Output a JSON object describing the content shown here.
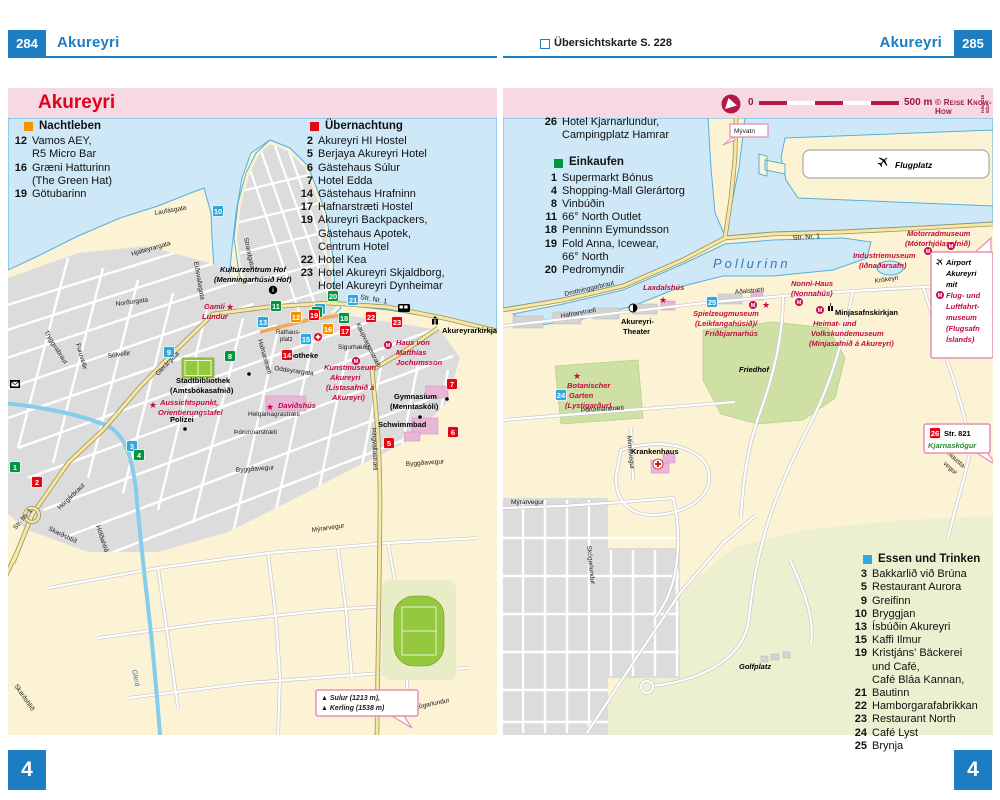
{
  "colors": {
    "header_blue": "#1d7dc2",
    "title_pink_bg": "#f7d9e4",
    "title_red": "#e2001a",
    "crimson": "#9b1440",
    "badge_orange": "#f39200",
    "badge_red": "#e30613",
    "badge_green": "#009640",
    "badge_blue": "#2fa8e0",
    "map_red": "#c30b3f",
    "sea": "#cfe8f7",
    "land": "#fbf3d4",
    "park_green": "#cfe0a4",
    "road_yellow": "#f6e7a2"
  },
  "left": {
    "header": {
      "page": "284",
      "title": "Akureyri"
    },
    "title": "Akureyri",
    "corner": "4",
    "nightlife": {
      "title": "Nachtleben",
      "items": [
        {
          "num": "12",
          "lines": [
            "Vamos AEY,",
            "R5 Micro Bar"
          ]
        },
        {
          "num": "16",
          "lines": [
            "Græni Hatturinn",
            "(The Green Hat)"
          ]
        },
        {
          "num": "19",
          "lines": [
            "Götubarinn"
          ]
        }
      ]
    },
    "lodging": {
      "title": "Übernachtung",
      "items": [
        {
          "num": "2",
          "lines": [
            "Akureyri HI Hostel"
          ]
        },
        {
          "num": "5",
          "lines": [
            "Berjaya Akureyri Hotel"
          ]
        },
        {
          "num": "6",
          "lines": [
            "Gästehaus Súlur"
          ]
        },
        {
          "num": "7",
          "lines": [
            "Hotel Edda"
          ]
        },
        {
          "num": "14",
          "lines": [
            "Gästehaus Hrafninn"
          ]
        },
        {
          "num": "17",
          "lines": [
            "Hafnarstræti Hostel"
          ]
        },
        {
          "num": "19",
          "lines": [
            "Akureyri Backpackers,",
            "Gästehaus Apotek,",
            "Centrum Hotel"
          ]
        },
        {
          "num": "22",
          "lines": [
            "Hotel Kea"
          ]
        },
        {
          "num": "23",
          "lines": [
            "Hotel Akureyri Skjaldborg,",
            "Hotel Akureyri Dynheimar"
          ]
        }
      ]
    },
    "map": {
      "streets": {
        "laufasgata": "Laufásgata",
        "hjalteyrargata": "Hjalteyrargata",
        "strandgata": "Strandgata",
        "eidsvallagata": "Eiðsvallagata",
        "nordurgata": "Norðurgata",
        "glerargata": "Glerárgata",
        "solvellir": "Sólvellir",
        "furuvellir": "Furuvellir",
        "tryggvabraut": "Tryggvabraut",
        "horgarbraut": "Hörgárbraut",
        "strnr1": "Str. Nr. 1",
        "skardshlid": "Skarðshlíð",
        "hofdahlid": "Höfðahlíð",
        "oddeyrargata": "Oddeyrargata",
        "helgamagrastraeti": "Helgamagrastræti",
        "thorunnarstraeti": "Þórunnarstræti",
        "byggdavegur": "Byggðavegur",
        "myrarvegur": "Mýrarvegur",
        "thingvallastraeti": "Þingvallastræti",
        "skogarlundur": "Skógarlundur",
        "hafnarstraeti": "Hafnarstræti",
        "kaupvangsstraeti": "Kaupvangsstræti",
        "rathaus1": "Rathaus-",
        "rathaus2": "platz",
        "glera": "Glerá"
      },
      "pois": {
        "hof1": "Kulturzentrum Hof",
        "hof2": "(Menningarhúsið Hof)",
        "gamli1": "Gamli",
        "gamli2": "Lundur",
        "kirkja": "Akureyrarkirkja",
        "haus1": "Haus von",
        "haus2": "Matthías",
        "haus3": "Jochumsson",
        "apotheke": "Apotheke",
        "sigurhaedir": "Sigurhæðir",
        "kunst1": "Kunstmuseum",
        "kunst2": "Akureyri",
        "kunst3": "(Listasafnið á",
        "kunst4": "Akureyri)",
        "gym1": "Gymnasium",
        "gym2": "(Menntaskóli)",
        "schwimmbad": "Schwimmbad",
        "bib1": "Stadtbibliothek",
        "bib2": "(Amtsbókasafnið)",
        "aus1": "Aussichtspunkt,",
        "aus2": "Orientierungstafel",
        "davidshus": "Davíðshús",
        "polizei": "Polizei"
      },
      "sign": {
        "line1": "▲ Sulur (1213 m),",
        "line2": "▲ Kerling (1538 m)"
      },
      "badges": {
        "1": "1",
        "2": "2",
        "3": "3",
        "4": "4",
        "5": "5",
        "6": "6",
        "7": "7",
        "8": "8",
        "9": "9",
        "10": "10",
        "11": "11",
        "12": "12",
        "13": "13",
        "14": "14",
        "15": "15",
        "16": "16",
        "17": "17",
        "18": "18",
        "19": "19",
        "20": "20",
        "21": "21",
        "22": "22",
        "23": "23"
      }
    }
  },
  "right": {
    "header": {
      "ref": "Übersichtskarte S. 228",
      "title": "Akureyri",
      "page": "285"
    },
    "scalebar": {
      "zero": "0",
      "label": "500 m",
      "copyright": "© Reise Know-How",
      "edition1": "Island18",
      "edition2": "6/24"
    },
    "corner": "4",
    "lodging_cont": {
      "num": "26",
      "lines": [
        "Hotel Kjarnarlundur,",
        "Campingplatz Hamrar"
      ]
    },
    "shopping": {
      "title": "Einkaufen",
      "items": [
        {
          "num": "1",
          "lines": [
            "Supermarkt Bónus"
          ]
        },
        {
          "num": "4",
          "lines": [
            "Shopping-Mall Glerártorg"
          ]
        },
        {
          "num": "8",
          "lines": [
            "Vinbúðin"
          ]
        },
        {
          "num": "11",
          "lines": [
            "66° North Outlet"
          ]
        },
        {
          "num": "18",
          "lines": [
            "Penninn Eymundsson"
          ]
        },
        {
          "num": "19",
          "lines": [
            "Fold Anna, Icewear,",
            "66° North"
          ]
        },
        {
          "num": "20",
          "lines": [
            "Pedromyndir"
          ]
        }
      ]
    },
    "dining": {
      "title": "Essen und Trinken",
      "items": [
        {
          "num": "3",
          "lines": [
            "Bakkarlið við Brúna"
          ]
        },
        {
          "num": "5",
          "lines": [
            "Restaurant Aurora"
          ]
        },
        {
          "num": "9",
          "lines": [
            "Greifinn"
          ]
        },
        {
          "num": "10",
          "lines": [
            "Bryggjan"
          ]
        },
        {
          "num": "13",
          "lines": [
            "Ísbúðin Akureyri"
          ]
        },
        {
          "num": "15",
          "lines": [
            "Kaffi Ilmur"
          ]
        },
        {
          "num": "19",
          "lines": [
            "Kristjáns' Bäckerei",
            "und Café,",
            "Café Bláa Kannan,"
          ]
        },
        {
          "num": "21",
          "lines": [
            "Bautinn"
          ]
        },
        {
          "num": "22",
          "lines": [
            "Hamborgarafabrikkan"
          ]
        },
        {
          "num": "23",
          "lines": [
            "Restaurant North"
          ]
        },
        {
          "num": "24",
          "lines": [
            "Café Lyst"
          ]
        },
        {
          "num": "25",
          "lines": [
            "Brynja"
          ]
        }
      ]
    },
    "map": {
      "water": "Pollurinn",
      "streets": {
        "drottninggarbraut": "Drottninggarbraut",
        "hafnarstraeti": "Hafnarstræti",
        "adalstraeti": "Aðalstræti",
        "strnr1": "Str. Nr. 1",
        "krokeyri": "Krókeyri",
        "nausta1": "Nausta-",
        "nausta2": "vegur",
        "myrarvegur": "Mýrarvegur",
        "mimisvegur": "Mímisvegur",
        "thorunnarstraeti": "Þórunnarstræti",
        "skogarlundur": "Skógarlundur"
      },
      "pois": {
        "flugplatz": "Flugplatz",
        "motorrad1": "Motorradmuseum",
        "motorrad2": "(Mótorhjólasafnið)",
        "industrie1": "Industriemuseum",
        "industrie2": "(Iðnaðarsafn)",
        "nonni1": "Nonni-Haus",
        "nonni2": "(Nonnahús)",
        "laxdalshus": "Laxdalshús",
        "spiel1": "Spielzeugmuseum",
        "spiel2": "(Leikfangahúsið)/",
        "spiel3": "Friðbjarnarhús",
        "minjakirkja": "Minjasafnskirkjan",
        "heimat1": "Heimat- und",
        "heimat2": "Volkskundemuseum",
        "heimat3": "(Minjasafnið á Akureyri)",
        "friedhof": "Friedhof",
        "theater1": "Akureyri-",
        "theater2": "Theater",
        "botan1": "Botanischer",
        "botan2": "Garten",
        "botan3": "(Lystigarður)",
        "krankenhaus": "Krankenhaus",
        "golfplatz": "Golfplatz"
      },
      "signs": {
        "myvatn": "Mývatn",
        "str821": "Str. 821",
        "kjarnaskogur": "Kjarnaskógur",
        "airport": [
          "Airport",
          "Akureyri",
          "mit",
          "Flug- und",
          "Luftfahrt-",
          "museum",
          "(Flugsafn",
          "Íslands)"
        ]
      },
      "badges": {
        "24": "24",
        "25": "25",
        "26": "26"
      }
    }
  }
}
